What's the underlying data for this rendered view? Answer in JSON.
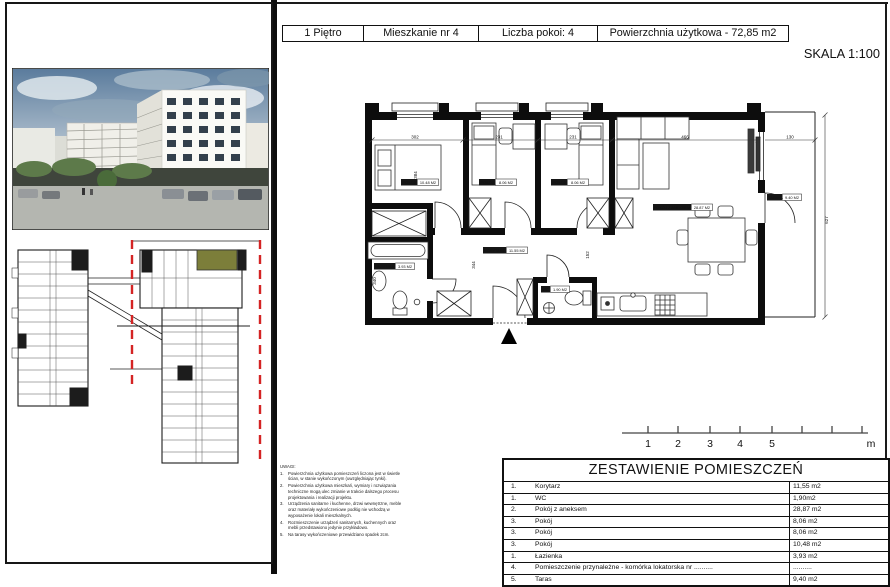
{
  "header": {
    "cells": [
      "1 Piętro",
      "Mieszkanie nr 4",
      "Liczba pokoi: 4",
      "Powierzchnia użytkowa - 72,85 m2"
    ],
    "scale_label": "SKALA 1:100"
  },
  "plan": {
    "labels": {
      "room1": {
        "name": "POKÓJ",
        "area": "10.48 M2"
      },
      "room2": {
        "name": "POKÓJ",
        "area": "8.06 M2"
      },
      "room3": {
        "name": "POKÓJ",
        "area": "8.06 M2"
      },
      "living": {
        "name": "POKÓJ Z ANEKSEM",
        "area": "28.87 M2"
      },
      "taras": {
        "name": "TARAS",
        "area": "9.40 M2"
      },
      "lazienka": {
        "name": "ŁAZIENKA",
        "area": "3.93 M2"
      },
      "korytarz": {
        "name": "KORYTARZ",
        "area": "11.55 M2"
      },
      "wc": {
        "name": "WC",
        "area": "1.90 M2"
      }
    },
    "dimensions": {
      "top": [
        "302",
        "231",
        "231",
        "466",
        "130"
      ],
      "right": "627",
      "room1_depth": "384",
      "corridor": "344",
      "bathroom": "340",
      "wc": "152"
    },
    "scale_bar": {
      "ticks": [
        "1",
        "2",
        "3",
        "4",
        "5"
      ],
      "unit": "m"
    }
  },
  "notes": {
    "title": "UWAGI:",
    "items": [
      {
        "no": "1.",
        "text": "Powierzchnia użytkowa pomieszczeń liczona jest w świetle ścian, w stanie wykończonym (uwzględniając tynki)."
      },
      {
        "no": "2.",
        "text": "Powierzchnia użytkowa mieszkań, wymiary i rozwiązania techniczne mogą ulec zmianie w trakcie dalszego procesu projektowania i realizacji projektu."
      },
      {
        "no": "3.",
        "text": "Urządzenia sanitarne i kuchenne, drzwi wewnętrzne, meble oraz materiały wykończeniowe podłóg nie wchodzą w wyposażenie lokali mieszkalnych."
      },
      {
        "no": "4.",
        "text": "Rozmieszczenie urządzeń sanitarnych, kuchennych oraz mebli przedstawiono jedynie przykładowo."
      },
      {
        "no": "5.",
        "text": "Na tarasy wykończeniowe przewidziano spadek 2cm."
      }
    ]
  },
  "rooms_table": {
    "title": "ZESTAWIENIE POMIESZCZEŃ",
    "rows": [
      {
        "no": "1.",
        "name": "Korytarz",
        "area": "11,55 m2"
      },
      {
        "no": "1.",
        "name": "WC",
        "area": "1,90m2"
      },
      {
        "no": "2.",
        "name": "Pokój z aneksem",
        "area": "28,87 m2"
      },
      {
        "no": "3.",
        "name": "Pokój",
        "area": "8,06 m2"
      },
      {
        "no": "3.",
        "name": "Pokój",
        "area": "8,06 m2"
      },
      {
        "no": "3.",
        "name": "Pokój",
        "area": "10,48 m2"
      },
      {
        "no": "1.",
        "name": "Łazienka",
        "area": "3,93 m2"
      },
      {
        "no": "4.",
        "name": "Pomieszczenie przynależne - komórka lokatorska nr ..........",
        "area": ".........."
      },
      {
        "no": "5.",
        "name": "Taras",
        "area": "9,40 m2"
      }
    ]
  },
  "colors": {
    "section_line_red": "#d42424",
    "highlighted_unit_olive": "#7c7e3a",
    "wall_black": "#0d0d0d"
  }
}
